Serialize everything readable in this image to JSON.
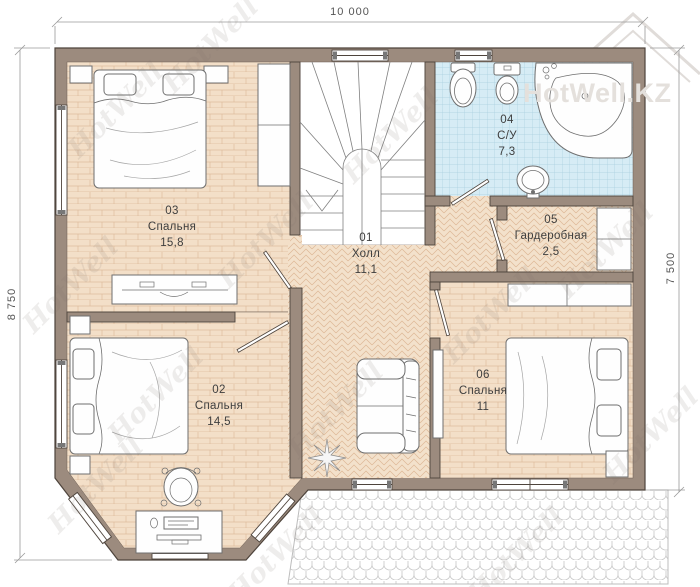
{
  "dimensions": {
    "top": "10 000",
    "left": "8 750",
    "right": "7 500"
  },
  "watermark": {
    "text": "HotWell",
    "logo": "HotWell.KZ"
  },
  "rooms": [
    {
      "number": "01",
      "name": "Холл",
      "area": "11,1"
    },
    {
      "number": "02",
      "name": "Спальня",
      "area": "14,5"
    },
    {
      "number": "03",
      "name": "Спальня",
      "area": "15,8"
    },
    {
      "number": "04",
      "name": "С/У",
      "area": "7,3"
    },
    {
      "number": "05",
      "name": "Гардеробная",
      "area": "2,5"
    },
    {
      "number": "06",
      "name": "Спальня",
      "area": "11"
    }
  ],
  "colors": {
    "wall": "#9c8b7e",
    "wall_outline": "#4e443c",
    "floor_wood": "#f3dfc8",
    "floor_wood_line": "#d8b492",
    "floor_herring": "#f3e1cb",
    "floor_herring_line": "#ddb795",
    "floor_tile": "#d6ecf5",
    "floor_tile_line": "#a9cfdf",
    "roof_line": "#c6c6c6",
    "furniture_outline": "#6f6f6f"
  }
}
